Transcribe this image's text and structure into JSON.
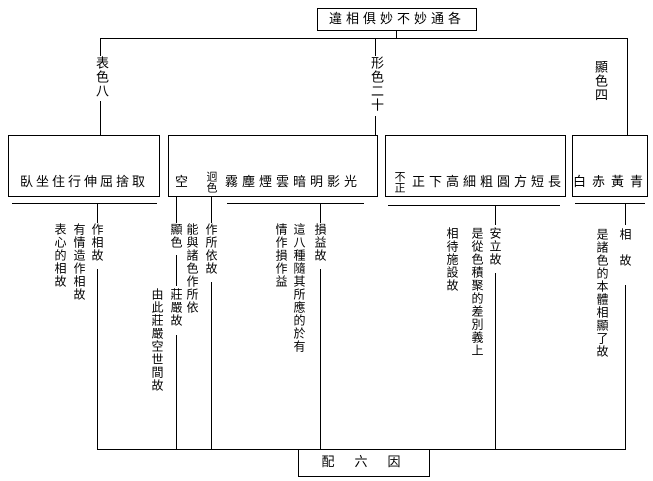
{
  "title": "違相俱妙不妙通各",
  "branches": {
    "left": "表色八",
    "middle": "形色二十",
    "right": "顯色四"
  },
  "boxes": {
    "biao": "臥坐住行伸屈捨取",
    "xing1": {
      "first": "空",
      "stacked": "迥色",
      "rest": "霧塵煙雲暗明影光"
    },
    "xing2": {
      "stacked": "不正",
      "rest": "正下高細粗圓方短長"
    },
    "xian": "白赤黃青"
  },
  "glosses": {
    "biao": {
      "chain": "作相故",
      "notes": [
        "有情造作相故",
        "表心的相故"
      ]
    },
    "kong": {
      "chain1": "顯色",
      "chain2": "莊嚴故",
      "note": "由此莊嚴空世間故"
    },
    "jiong": {
      "chain": "作所依故",
      "note": "能與諸色作所依"
    },
    "wu_guang": {
      "chain": "損益故",
      "notes": [
        "這八種隨其所應的於有",
        "情作損作益"
      ]
    },
    "xing": {
      "chain": "安立故",
      "notes": [
        "是從色積聚的差別義上",
        "相待施設故"
      ]
    },
    "xian": {
      "chain": "相　故",
      "note": "是諸色的本體相顯了故"
    }
  },
  "footer": "配六因相"
}
